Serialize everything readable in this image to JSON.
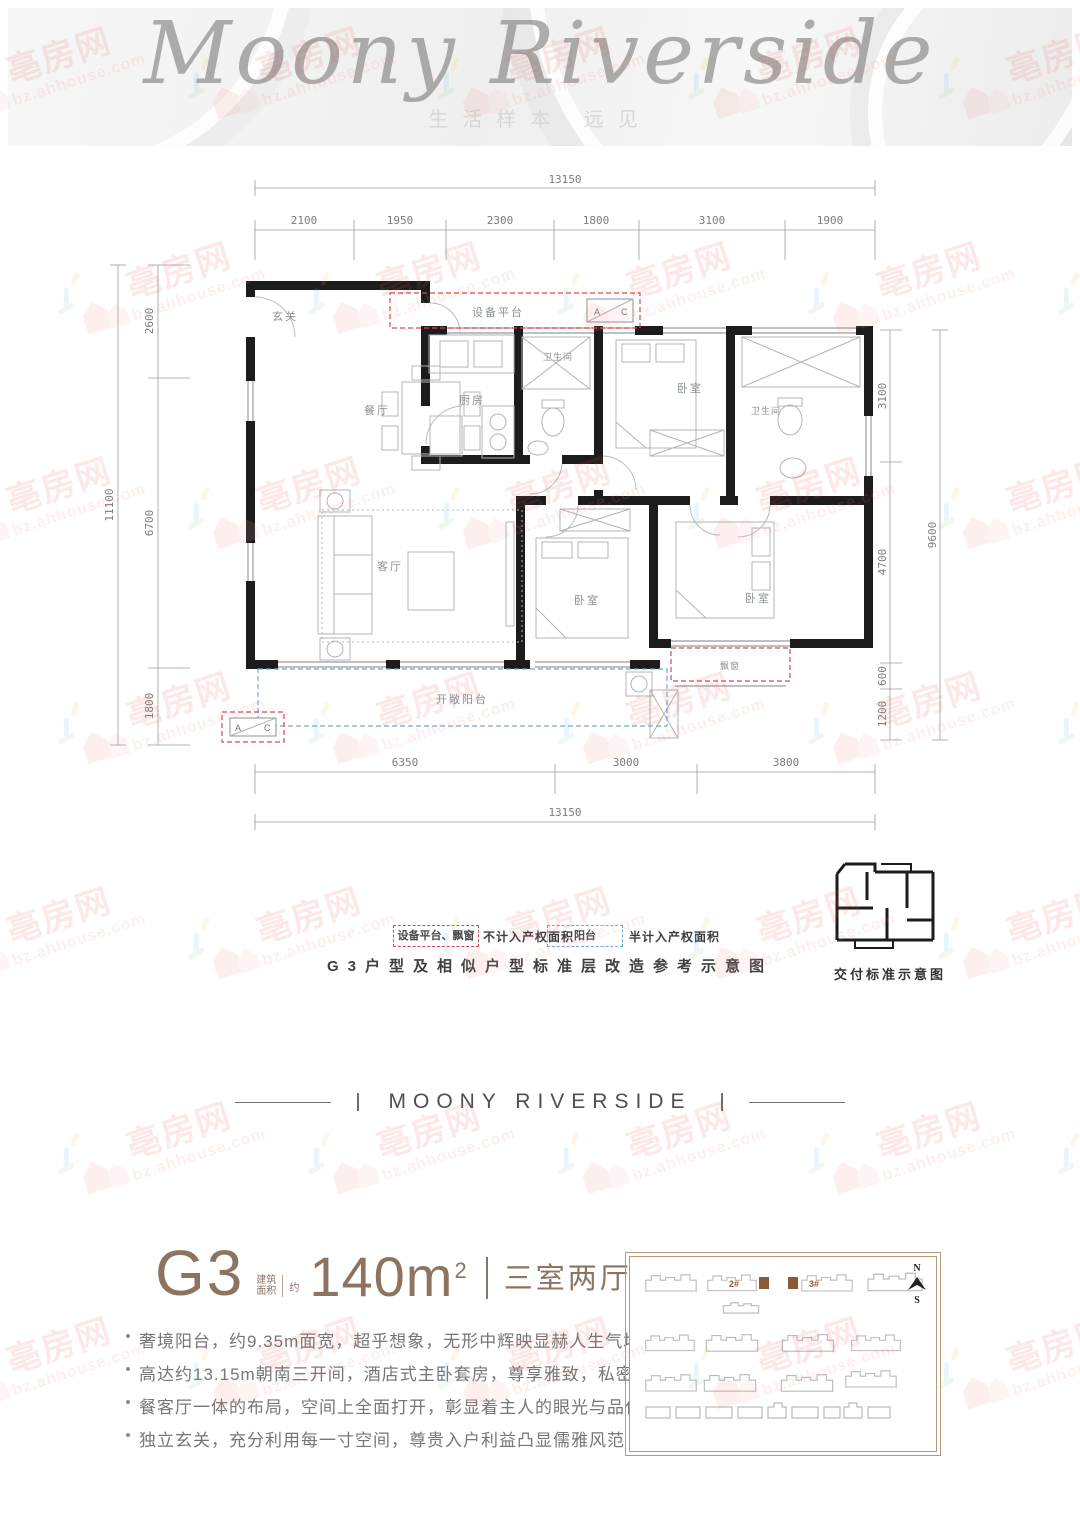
{
  "watermark": {
    "site_name": "亳房网",
    "site_url": "bz.ahhouse.com"
  },
  "header": {
    "title_script": "Moony Riverside",
    "slogan": "生活样本 远见"
  },
  "plan": {
    "rooms": {
      "entry": "玄关",
      "dining": "餐厅",
      "kitchen": "厨房",
      "bath_top": "卫生间",
      "bedroom_top": "卧室",
      "bath_right": "卫生间",
      "living": "客厅",
      "bedroom_mid": "卧室",
      "bedroom_right": "卧室",
      "balcony": "开敞阳台",
      "bay_window": "飘窗",
      "equipment": "设备平台",
      "ac_a": "A",
      "ac_c": "C"
    },
    "dims": {
      "top_total": "13150",
      "top": [
        "2100",
        "1950",
        "2300",
        "1800",
        "3100",
        "1900"
      ],
      "left_total": "11100",
      "left": [
        "2600",
        "6700",
        "1800"
      ],
      "right_total": "9600",
      "right": [
        "3100",
        "4700",
        "600",
        "1200"
      ],
      "bottom": [
        "6350",
        "3000",
        "3800"
      ],
      "bottom_total": "13150"
    }
  },
  "legend": {
    "red_label": "设备平台、飘窗",
    "red_desc": "不计入产权面积",
    "blue_label": "阳台",
    "blue_desc": "半计入产权面积"
  },
  "captions": {
    "plan_caption": "G3户型及相似户型标准层改造参考示意图",
    "delivery_caption": "交付标准示意图"
  },
  "divider": {
    "text": "MOONY RIVERSIDE"
  },
  "unit": {
    "name": "G3",
    "area_prefix_line1": "建筑",
    "area_prefix_line2": "面积",
    "approx": "约",
    "area_value": "140m",
    "area_sup": "2",
    "layout": "三室两厅两卫",
    "features": [
      "奢境阳台，约9.35m面宽，超乎想象，无形中辉映显赫人生气场",
      "高达约13.15m朝南三开间，酒店式主卧套房，尊享雅致，私密舒心",
      "餐客厅一体的布局，空间上全面打开，彰显着主人的眼光与品位",
      "独立玄关，充分利用每一寸空间，尊贵入户利益凸显儒雅风范"
    ]
  },
  "siteplan": {
    "building_2": "2#",
    "building_3": "3#",
    "compass_n": "N",
    "compass_s": "S"
  },
  "colors": {
    "accent_brown": "#8c7460",
    "dash_red": "#d34a4a",
    "dash_blue": "#6fa8d8",
    "wall": "#1c1c1c",
    "watermark_red": "#e2574c"
  }
}
